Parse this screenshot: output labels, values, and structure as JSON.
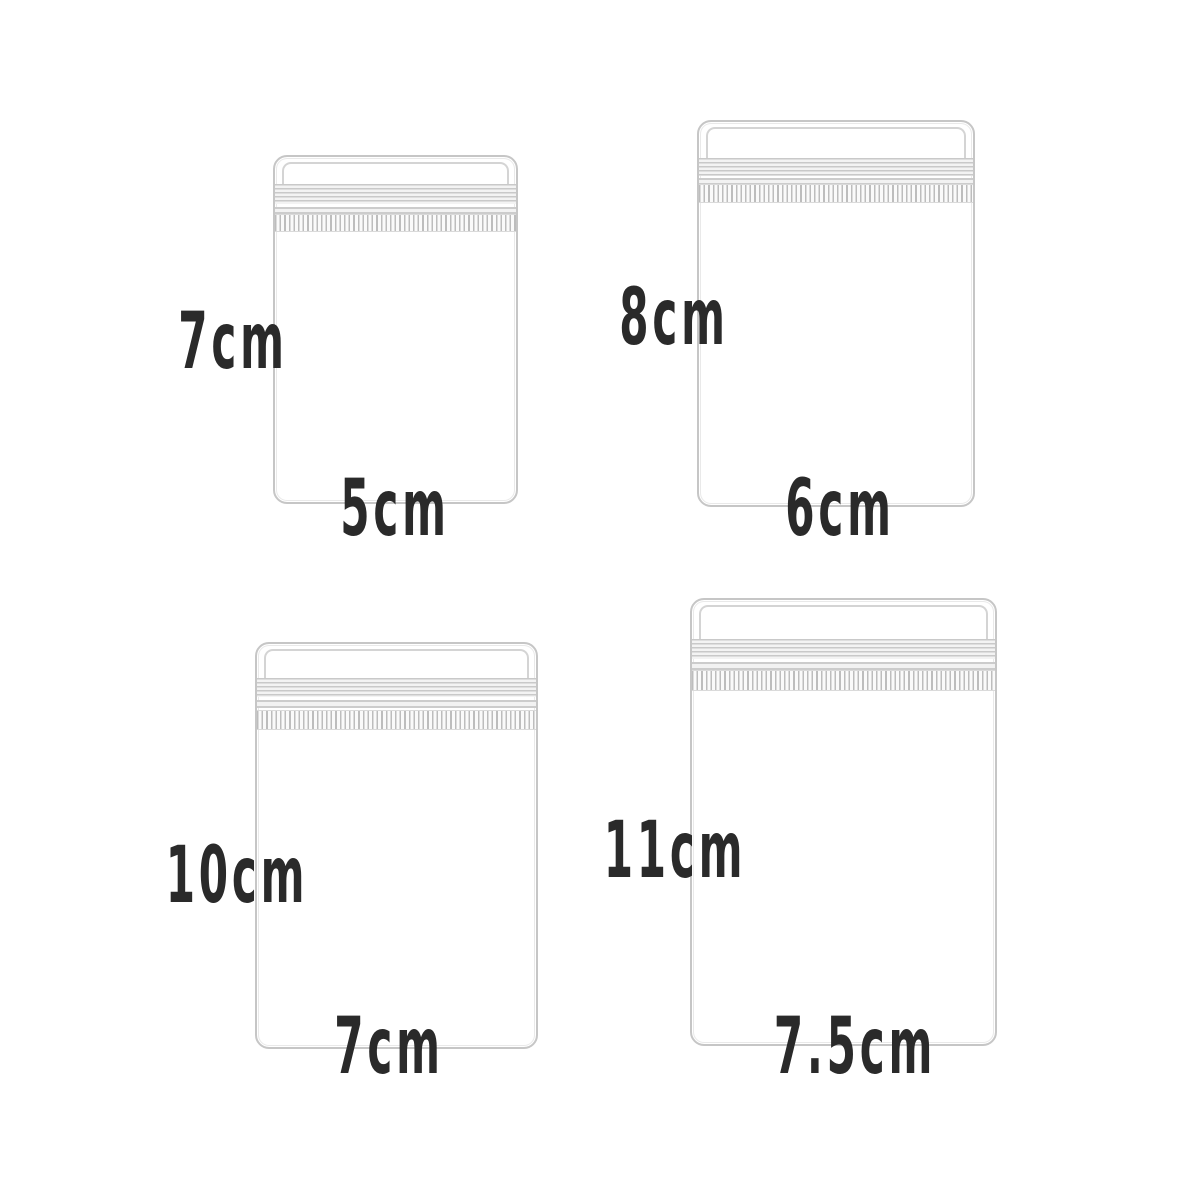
{
  "image": {
    "type": "product-dimension-diagram",
    "subject": "clear zip-lock plastic bags in four sizes",
    "background_color": "#ffffff"
  },
  "colors": {
    "bag_outline": "#c6c6c6",
    "zipper_lines": "#c9c9c9",
    "label_text": "#2a2a2a"
  },
  "bags": [
    {
      "id": "bag-5x7cm",
      "position": "top-left",
      "height_label": "7cm",
      "width_label": "5cm"
    },
    {
      "id": "bag-6x8cm",
      "position": "top-right",
      "height_label": "8cm",
      "width_label": "6cm"
    },
    {
      "id": "bag-7x10cm",
      "position": "bottom-left",
      "height_label": "10cm",
      "width_label": "7cm"
    },
    {
      "id": "bag-7.5x11cm",
      "position": "bottom-right",
      "height_label": "11cm",
      "width_label": "7.5cm"
    }
  ]
}
